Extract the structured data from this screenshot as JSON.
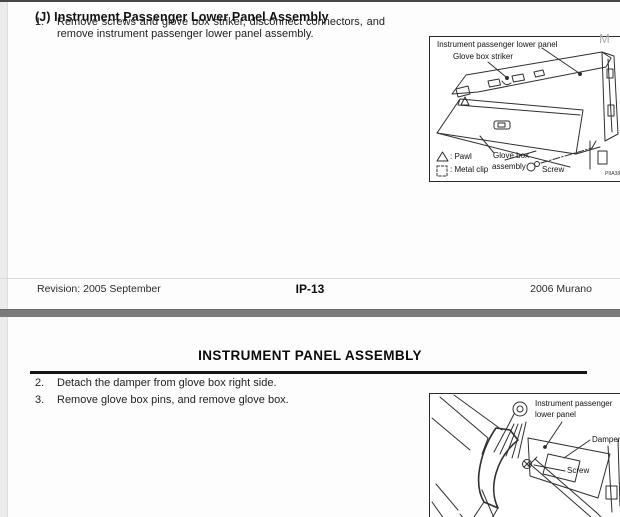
{
  "watermark": "M",
  "page1": {
    "heading": "(J) Instrument Passenger Lower Panel Assembly",
    "steps": [
      {
        "num": "1.",
        "text": "Remove screws and glove box striker, disconnect connectors, and remove instrument passenger lower panel assembly."
      }
    ],
    "figure": {
      "panel_label": "Instrument passenger lower panel",
      "striker_label": "Glove box striker",
      "pawl_label": ": Pawl",
      "metal_clip_label": ": Metal clip",
      "assembly_label_line1": "Glove box",
      "assembly_label_line2": "assembly",
      "screw_label": "Screw",
      "code": "PIIA3893E"
    },
    "footer": {
      "revision": "Revision: 2005 September",
      "page": "IP-13",
      "model": "2006 Murano"
    }
  },
  "page2": {
    "heading": "INSTRUMENT PANEL ASSEMBLY",
    "steps": [
      {
        "num": "2.",
        "text": "Detach the damper from glove box right side."
      },
      {
        "num": "3.",
        "text": "Remove glove box pins, and remove glove box."
      }
    ],
    "figure": {
      "panel_label_line1": "Instrument passenger",
      "panel_label_line2": "lower panel",
      "damper_label": "Damper",
      "screw_label": "Screw",
      "glove_box_label": "Glove box",
      "code": "PIIA3855E"
    }
  }
}
